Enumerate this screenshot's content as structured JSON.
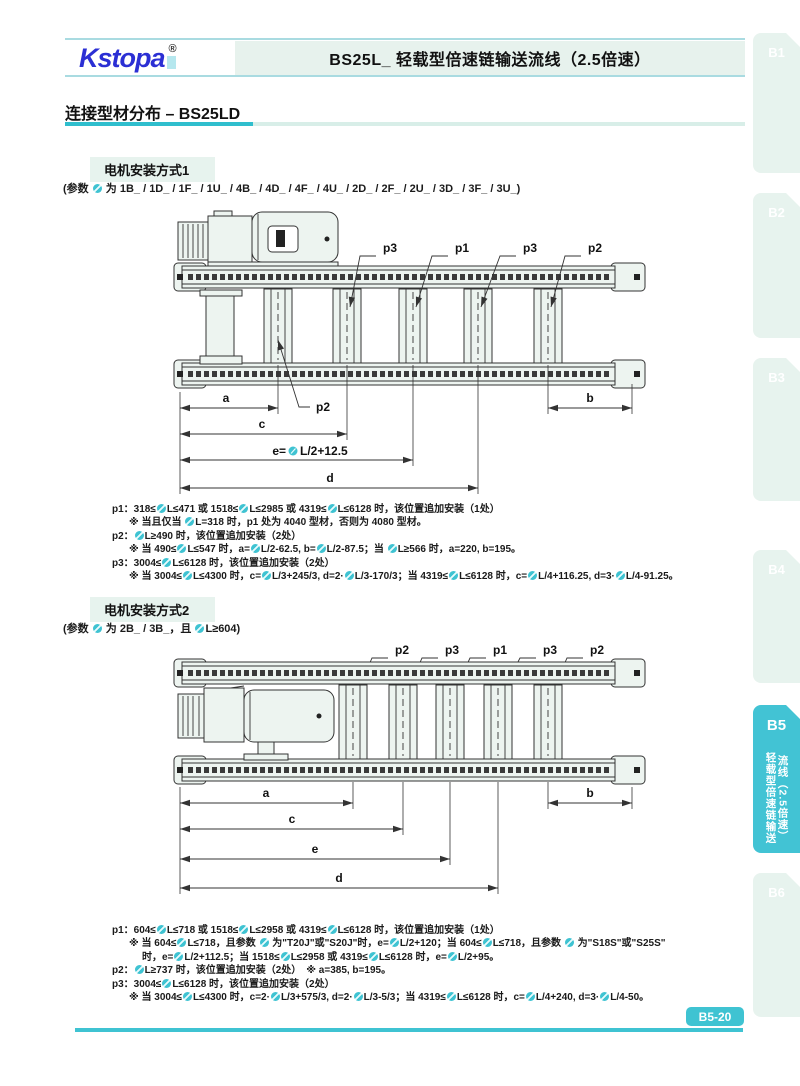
{
  "header": {
    "logo_text": "Kstopa",
    "registered_mark": "®",
    "title": "BS25L_ 轻载型倍速链输送流线（2.5倍速）"
  },
  "page": {
    "section_title": "连接型材分布 – BS25LD",
    "page_badge": "B5-20"
  },
  "colors": {
    "accent_teal": "#3fc3d2",
    "panel_green": "#e7f3ee",
    "logo_blue": "#2b2fd4"
  },
  "side_tabs": [
    {
      "label": "B1",
      "active": false
    },
    {
      "label": "B2",
      "active": false
    },
    {
      "label": "B3",
      "active": false
    },
    {
      "label": "B4",
      "active": false
    },
    {
      "label": "B5",
      "active": true,
      "vertical_text_right": "流线（2.5倍速）",
      "vertical_text_left": "轻载型倍速链输送"
    },
    {
      "label": "B6",
      "active": false
    }
  ],
  "section1": {
    "heading": "电机安装方式1",
    "params": "(参数 ● 为 1B_ / 1D_ / 1F_ / 1U_ / 4B_ / 4D_ / 4F_ / 4U_ / 2D_ / 2F_ / 2U_ / 3D_ / 3F_ / 3U_)",
    "diagram": {
      "top_labels": [
        "p3",
        "p1",
        "p3",
        "p2"
      ],
      "bottom_label": "p2",
      "dim_a": "a",
      "dim_b": "b",
      "dim_c": "c",
      "dim_d": "d",
      "dim_e_prefix": "e=",
      "dim_e_suffix": "L/2+12.5"
    },
    "notes": [
      {
        "text": "p1：318≤●L≤471 或 1518≤●L≤2985 或 4319≤●L≤6128 时，该位置追加安装（1处）"
      },
      {
        "text": "※ 当且仅当 ●L=318 时，p1 处为 4040 型材，否则为 4080 型材。"
      },
      {
        "text": "p2：●L≥490 时，该位置追加安装（2处）"
      },
      {
        "text": "※ 当 490≤●L≤547 时，a=●L/2-62.5, b=●L/2-87.5；当 ●L≥566 时，a=220, b=195。"
      },
      {
        "text": "p3：3004≤●L≤6128 时，该位置追加安装（2处）"
      },
      {
        "text": "※ 当 3004≤●L≤4300 时，c=●L/3+245/3, d=2·●L/3-170/3；当 4319≤●L≤6128 时，c=●L/4+116.25, d=3·●L/4-91.25。"
      }
    ]
  },
  "section2": {
    "heading": "电机安装方式2",
    "params": "(参数 ● 为 2B_ / 3B_，且 ●L≥604)",
    "diagram": {
      "top_labels": [
        "p2",
        "p3",
        "p1",
        "p3",
        "p2"
      ],
      "dim_a": "a",
      "dim_b": "b",
      "dim_c": "c",
      "dim_d": "d",
      "dim_e": "e"
    },
    "notes": [
      {
        "text": "p1：604≤●L≤718 或 1518≤●L≤2958 或 4319≤●L≤6128 时，该位置追加安装（1处）"
      },
      {
        "text": "※ 当 604≤●L≤718，且参数 ● 为\"T20J\"或\"S20J\"时，e=●L/2+120；当 604≤●L≤718，且参数 ● 为\"S18S\"或\"S25S\""
      },
      {
        "text": "时，e=●L/2+112.5；当 1518≤●L≤2958 或 4319≤●L≤6128 时，e=●L/2+95。"
      },
      {
        "text": "p2：●L≥737 时，该位置追加安装（2处）　※ a=385, b=195。"
      },
      {
        "text": "p3：3004≤●L≤6128 时，该位置追加安装（2处）"
      },
      {
        "text": "※ 当 3004≤●L≤4300 时，c=2·●L/3+575/3, d=2·●L/3-5/3；当 4319≤●L≤6128 时，c=●L/4+240, d=3·●L/4-50。"
      }
    ]
  }
}
